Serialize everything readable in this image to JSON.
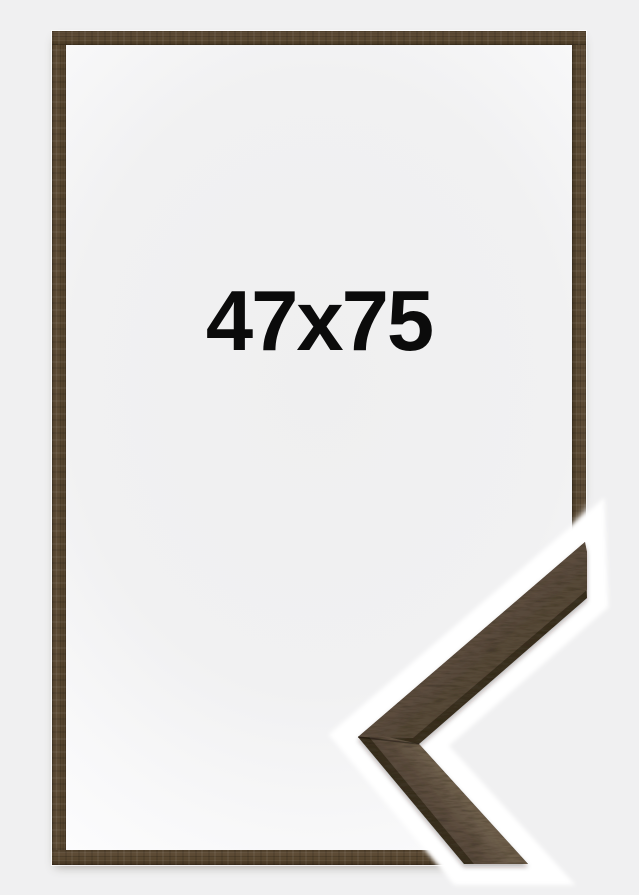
{
  "product": {
    "size_label": "47x75"
  },
  "frame": {
    "material": "dark brown wood",
    "corner_sample_visible": true
  },
  "colors": {
    "background": "#f0f0f1",
    "wood_base": "#57462f",
    "wood_side_dark": "#3b3024",
    "wood_face_light": "#6e5f4c",
    "wood_face_shade": "#564839",
    "interior_center": "#efeff0",
    "interior_edge": "#fcfcfd",
    "halo": "#ffffff",
    "label_text": "#0b0b0b"
  }
}
